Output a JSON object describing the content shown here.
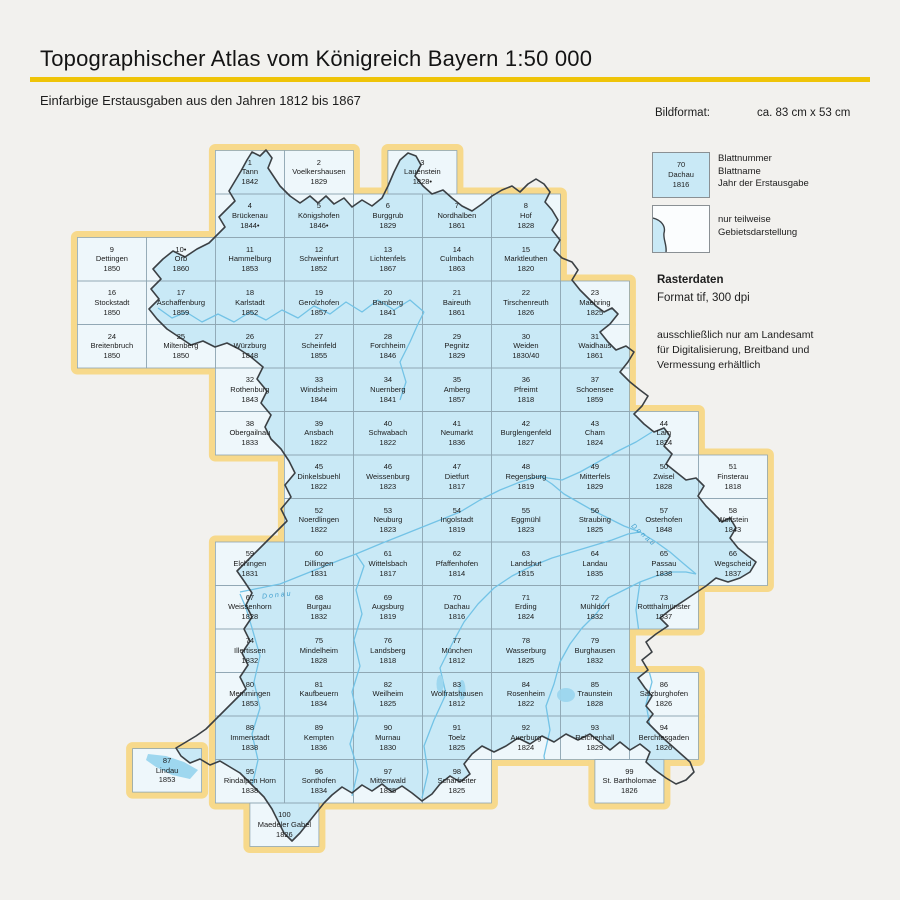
{
  "header": {
    "title": "Topographischer Atlas vom Königreich Bayern 1:50 000",
    "subtitle": "Einfarbige Erstausgaben aus den Jahren 1812 bis 1867"
  },
  "info": {
    "bildformat_label": "Bildformat:",
    "bildformat_value": "ca. 83 cm x 53 cm"
  },
  "legend": {
    "sample": {
      "number": "70",
      "name": "Dachau",
      "year": "1816"
    },
    "sample_labels": {
      "line1": "Blattnummer",
      "line2": "Blattname",
      "line3": "Jahr der Erstausgabe"
    },
    "partial_label": "nur teilweise Gebietsdarstellung"
  },
  "raster": {
    "title": "Rasterdaten",
    "format": "Format tif, 300 dpi",
    "availability": "ausschließlich nur am Landesamt für Digitalisierung, Breitband und Vermessung erhältlich"
  },
  "map": {
    "river_label": "Donau",
    "cells": [
      {
        "n": "1",
        "name": "Tann",
        "year": "1842",
        "r": 0,
        "c": 2
      },
      {
        "n": "2",
        "name": "Voelkershausen",
        "year": "1829",
        "r": 0,
        "c": 3
      },
      {
        "n": "3",
        "name": "Lauenstein",
        "year": "1828•",
        "r": 0,
        "c": 4.5
      },
      {
        "n": "4",
        "name": "Brückenau",
        "year": "1844•",
        "r": 1,
        "c": 2
      },
      {
        "n": "5",
        "name": "Königshofen",
        "year": "1846•",
        "r": 1,
        "c": 3
      },
      {
        "n": "6",
        "name": "Burggrub",
        "year": "1829",
        "r": 1,
        "c": 4
      },
      {
        "n": "7",
        "name": "Nordhalben",
        "year": "1861",
        "r": 1,
        "c": 5
      },
      {
        "n": "8",
        "name": "Hof",
        "year": "1828",
        "r": 1,
        "c": 6
      },
      {
        "n": "9",
        "name": "Dettingen",
        "year": "1850",
        "r": 2,
        "c": 0
      },
      {
        "n": "10•",
        "name": "Orb",
        "year": "1860",
        "r": 2,
        "c": 1
      },
      {
        "n": "11",
        "name": "Hammelburg",
        "year": "1853",
        "r": 2,
        "c": 2
      },
      {
        "n": "12",
        "name": "Schweinfurt",
        "year": "1852",
        "r": 2,
        "c": 3
      },
      {
        "n": "13",
        "name": "Lichtenfels",
        "year": "1867",
        "r": 2,
        "c": 4
      },
      {
        "n": "14",
        "name": "Culmbach",
        "year": "1863",
        "r": 2,
        "c": 5
      },
      {
        "n": "15",
        "name": "Marktleuthen",
        "year": "1820",
        "r": 2,
        "c": 6
      },
      {
        "n": "16",
        "name": "Stockstadt",
        "year": "1850",
        "r": 3,
        "c": 0
      },
      {
        "n": "17",
        "name": "Aschaffenburg",
        "year": "1859",
        "r": 3,
        "c": 1
      },
      {
        "n": "18",
        "name": "Karlstadt",
        "year": "1852",
        "r": 3,
        "c": 2
      },
      {
        "n": "19",
        "name": "Gerolzhofen",
        "year": "1857",
        "r": 3,
        "c": 3
      },
      {
        "n": "20",
        "name": "Bamberg",
        "year": "1841",
        "r": 3,
        "c": 4
      },
      {
        "n": "21",
        "name": "Baireuth",
        "year": "1861",
        "r": 3,
        "c": 5
      },
      {
        "n": "22",
        "name": "Tirschenreuth",
        "year": "1826",
        "r": 3,
        "c": 6
      },
      {
        "n": "23",
        "name": "Maehring",
        "year": "1825",
        "r": 3,
        "c": 7
      },
      {
        "n": "24",
        "name": "Breitenbruch",
        "year": "1850",
        "r": 4,
        "c": 0
      },
      {
        "n": "25",
        "name": "Miltenberg",
        "year": "1850",
        "r": 4,
        "c": 1
      },
      {
        "n": "26",
        "name": "Würzburg",
        "year": "1848",
        "r": 4,
        "c": 2
      },
      {
        "n": "27",
        "name": "Scheinfeld",
        "year": "1855",
        "r": 4,
        "c": 3
      },
      {
        "n": "28",
        "name": "Forchheim",
        "year": "1846",
        "r": 4,
        "c": 4
      },
      {
        "n": "29",
        "name": "Pegnitz",
        "year": "1829",
        "r": 4,
        "c": 5
      },
      {
        "n": "30",
        "name": "Weiden",
        "year": "1830/40",
        "r": 4,
        "c": 6
      },
      {
        "n": "31",
        "name": "Waidhaus",
        "year": "1861",
        "r": 4,
        "c": 7
      },
      {
        "n": "32",
        "name": "Rothenburg",
        "year": "1843",
        "r": 5,
        "c": 2
      },
      {
        "n": "33",
        "name": "Windsheim",
        "year": "1844",
        "r": 5,
        "c": 3
      },
      {
        "n": "34",
        "name": "Nuernberg",
        "year": "1841",
        "r": 5,
        "c": 4
      },
      {
        "n": "35",
        "name": "Amberg",
        "year": "1857",
        "r": 5,
        "c": 5
      },
      {
        "n": "36",
        "name": "Pfreimt",
        "year": "1818",
        "r": 5,
        "c": 6
      },
      {
        "n": "37",
        "name": "Schoensee",
        "year": "1859",
        "r": 5,
        "c": 7
      },
      {
        "n": "38",
        "name": "Obergailnau",
        "year": "1833",
        "r": 6,
        "c": 2
      },
      {
        "n": "39",
        "name": "Ansbach",
        "year": "1822",
        "r": 6,
        "c": 3
      },
      {
        "n": "40",
        "name": "Schwabach",
        "year": "1822",
        "r": 6,
        "c": 4
      },
      {
        "n": "41",
        "name": "Neumarkt",
        "year": "1836",
        "r": 6,
        "c": 5
      },
      {
        "n": "42",
        "name": "Burglengenfeld",
        "year": "1827",
        "r": 6,
        "c": 6
      },
      {
        "n": "43",
        "name": "Cham",
        "year": "1824",
        "r": 6,
        "c": 7
      },
      {
        "n": "44",
        "name": "Lam",
        "year": "1824",
        "r": 6,
        "c": 8
      },
      {
        "n": "45",
        "name": "Dinkelsbuehl",
        "year": "1822",
        "r": 7,
        "c": 3
      },
      {
        "n": "46",
        "name": "Weissenburg",
        "year": "1823",
        "r": 7,
        "c": 4
      },
      {
        "n": "47",
        "name": "Dietfurt",
        "year": "1817",
        "r": 7,
        "c": 5
      },
      {
        "n": "48",
        "name": "Regensburg",
        "year": "1819",
        "r": 7,
        "c": 6
      },
      {
        "n": "49",
        "name": "Mitterfels",
        "year": "1829",
        "r": 7,
        "c": 7
      },
      {
        "n": "50",
        "name": "Zwisel",
        "year": "1828",
        "r": 7,
        "c": 8
      },
      {
        "n": "51",
        "name": "Finsterau",
        "year": "1818",
        "r": 7,
        "c": 9
      },
      {
        "n": "52",
        "name": "Noerdlingen",
        "year": "1822",
        "r": 8,
        "c": 3
      },
      {
        "n": "53",
        "name": "Neuburg",
        "year": "1823",
        "r": 8,
        "c": 4
      },
      {
        "n": "54",
        "name": "Ingolstadt",
        "year": "1819",
        "r": 8,
        "c": 5
      },
      {
        "n": "55",
        "name": "Eggmühl",
        "year": "1823",
        "r": 8,
        "c": 6
      },
      {
        "n": "56",
        "name": "Straubing",
        "year": "1825",
        "r": 8,
        "c": 7
      },
      {
        "n": "57",
        "name": "Osterhofen",
        "year": "1848",
        "r": 8,
        "c": 8
      },
      {
        "n": "58",
        "name": "Wolfstein",
        "year": "1843",
        "r": 8,
        "c": 9
      },
      {
        "n": "59",
        "name": "Elchingen",
        "year": "1831",
        "r": 9,
        "c": 2
      },
      {
        "n": "60",
        "name": "Dillingen",
        "year": "1831",
        "r": 9,
        "c": 3
      },
      {
        "n": "61",
        "name": "Wittelsbach",
        "year": "1817",
        "r": 9,
        "c": 4
      },
      {
        "n": "62",
        "name": "Pfaffenhofen",
        "year": "1814",
        "r": 9,
        "c": 5
      },
      {
        "n": "63",
        "name": "Landshut",
        "year": "1815",
        "r": 9,
        "c": 6
      },
      {
        "n": "64",
        "name": "Landau",
        "year": "1835",
        "r": 9,
        "c": 7
      },
      {
        "n": "65",
        "name": "Passau",
        "year": "1838",
        "r": 9,
        "c": 8
      },
      {
        "n": "66",
        "name": "Wegscheid",
        "year": "1837",
        "r": 9,
        "c": 9
      },
      {
        "n": "67",
        "name": "Weissenhorn",
        "year": "1828",
        "r": 10,
        "c": 2
      },
      {
        "n": "68",
        "name": "Burgau",
        "year": "1832",
        "r": 10,
        "c": 3
      },
      {
        "n": "69",
        "name": "Augsburg",
        "year": "1819",
        "r": 10,
        "c": 4
      },
      {
        "n": "70",
        "name": "Dachau",
        "year": "1816",
        "r": 10,
        "c": 5
      },
      {
        "n": "71",
        "name": "Erding",
        "year": "1824",
        "r": 10,
        "c": 6
      },
      {
        "n": "72",
        "name": "Mühldorf",
        "year": "1832",
        "r": 10,
        "c": 7
      },
      {
        "n": "73",
        "name": "Rottthalmünster",
        "year": "1837",
        "r": 10,
        "c": 8
      },
      {
        "n": "74",
        "name": "Illertissen",
        "year": "1832",
        "r": 11,
        "c": 2
      },
      {
        "n": "75",
        "name": "Mindelheim",
        "year": "1828",
        "r": 11,
        "c": 3
      },
      {
        "n": "76",
        "name": "Landsberg",
        "year": "1818",
        "r": 11,
        "c": 4
      },
      {
        "n": "77",
        "name": "München",
        "year": "1812",
        "r": 11,
        "c": 5
      },
      {
        "n": "78",
        "name": "Wasserburg",
        "year": "1825",
        "r": 11,
        "c": 6
      },
      {
        "n": "79",
        "name": "Burghausen",
        "year": "1832",
        "r": 11,
        "c": 7
      },
      {
        "n": "80",
        "name": "Memmingen",
        "year": "1853",
        "r": 12,
        "c": 2
      },
      {
        "n": "81",
        "name": "Kaufbeuern",
        "year": "1834",
        "r": 12,
        "c": 3
      },
      {
        "n": "82",
        "name": "Weilheim",
        "year": "1825",
        "r": 12,
        "c": 4
      },
      {
        "n": "83",
        "name": "Wolfratshausen",
        "year": "1812",
        "r": 12,
        "c": 5
      },
      {
        "n": "84",
        "name": "Rosenheim",
        "year": "1822",
        "r": 12,
        "c": 6
      },
      {
        "n": "85",
        "name": "Traunstein",
        "year": "1828",
        "r": 12,
        "c": 7
      },
      {
        "n": "86",
        "name": "Salzburghofen",
        "year": "1826",
        "r": 12,
        "c": 8
      },
      {
        "n": "87",
        "name": "Lindau",
        "year": "1853",
        "r": 13.75,
        "c": 0.8
      },
      {
        "n": "88",
        "name": "Immenstadt",
        "year": "1838",
        "r": 13,
        "c": 2
      },
      {
        "n": "89",
        "name": "Kempten",
        "year": "1836",
        "r": 13,
        "c": 3
      },
      {
        "n": "90",
        "name": "Murnau",
        "year": "1830",
        "r": 13,
        "c": 4
      },
      {
        "n": "91",
        "name": "Toelz",
        "year": "1825",
        "r": 13,
        "c": 5
      },
      {
        "n": "92",
        "name": "Auerburg",
        "year": "1824",
        "r": 13,
        "c": 6
      },
      {
        "n": "93",
        "name": "Reichenhall",
        "year": "1829",
        "r": 13,
        "c": 7
      },
      {
        "n": "94",
        "name": "Berchtesgaden",
        "year": "1826",
        "r": 13,
        "c": 8
      },
      {
        "n": "95",
        "name": "Rindalpen Horn",
        "year": "1838",
        "r": 14,
        "c": 2
      },
      {
        "n": "96",
        "name": "Sonthofen",
        "year": "1834",
        "r": 14,
        "c": 3
      },
      {
        "n": "97",
        "name": "Mittenwald",
        "year": "1835",
        "r": 14,
        "c": 4
      },
      {
        "n": "98",
        "name": "Scharfreiter",
        "year": "1825",
        "r": 14,
        "c": 5
      },
      {
        "n": "99",
        "name": "St. Bartholomae",
        "year": "1826",
        "r": 14,
        "c": 7.5
      },
      {
        "n": "100",
        "name": "Maedeler Gabel",
        "year": "1826",
        "r": 15,
        "c": 2.5
      }
    ]
  },
  "colors": {
    "page_bg": "#f2f1ee",
    "accent_yellow": "#efc408",
    "ring_tan": "#f7d98b",
    "cell_pale": "#eef7fb",
    "bavaria_blue": "#c9e9f6",
    "grid_line": "#8ea6b2",
    "outline_dark": "#3b4044",
    "river_blue": "#73c3e6",
    "lake_blue": "#9ed7ef"
  }
}
